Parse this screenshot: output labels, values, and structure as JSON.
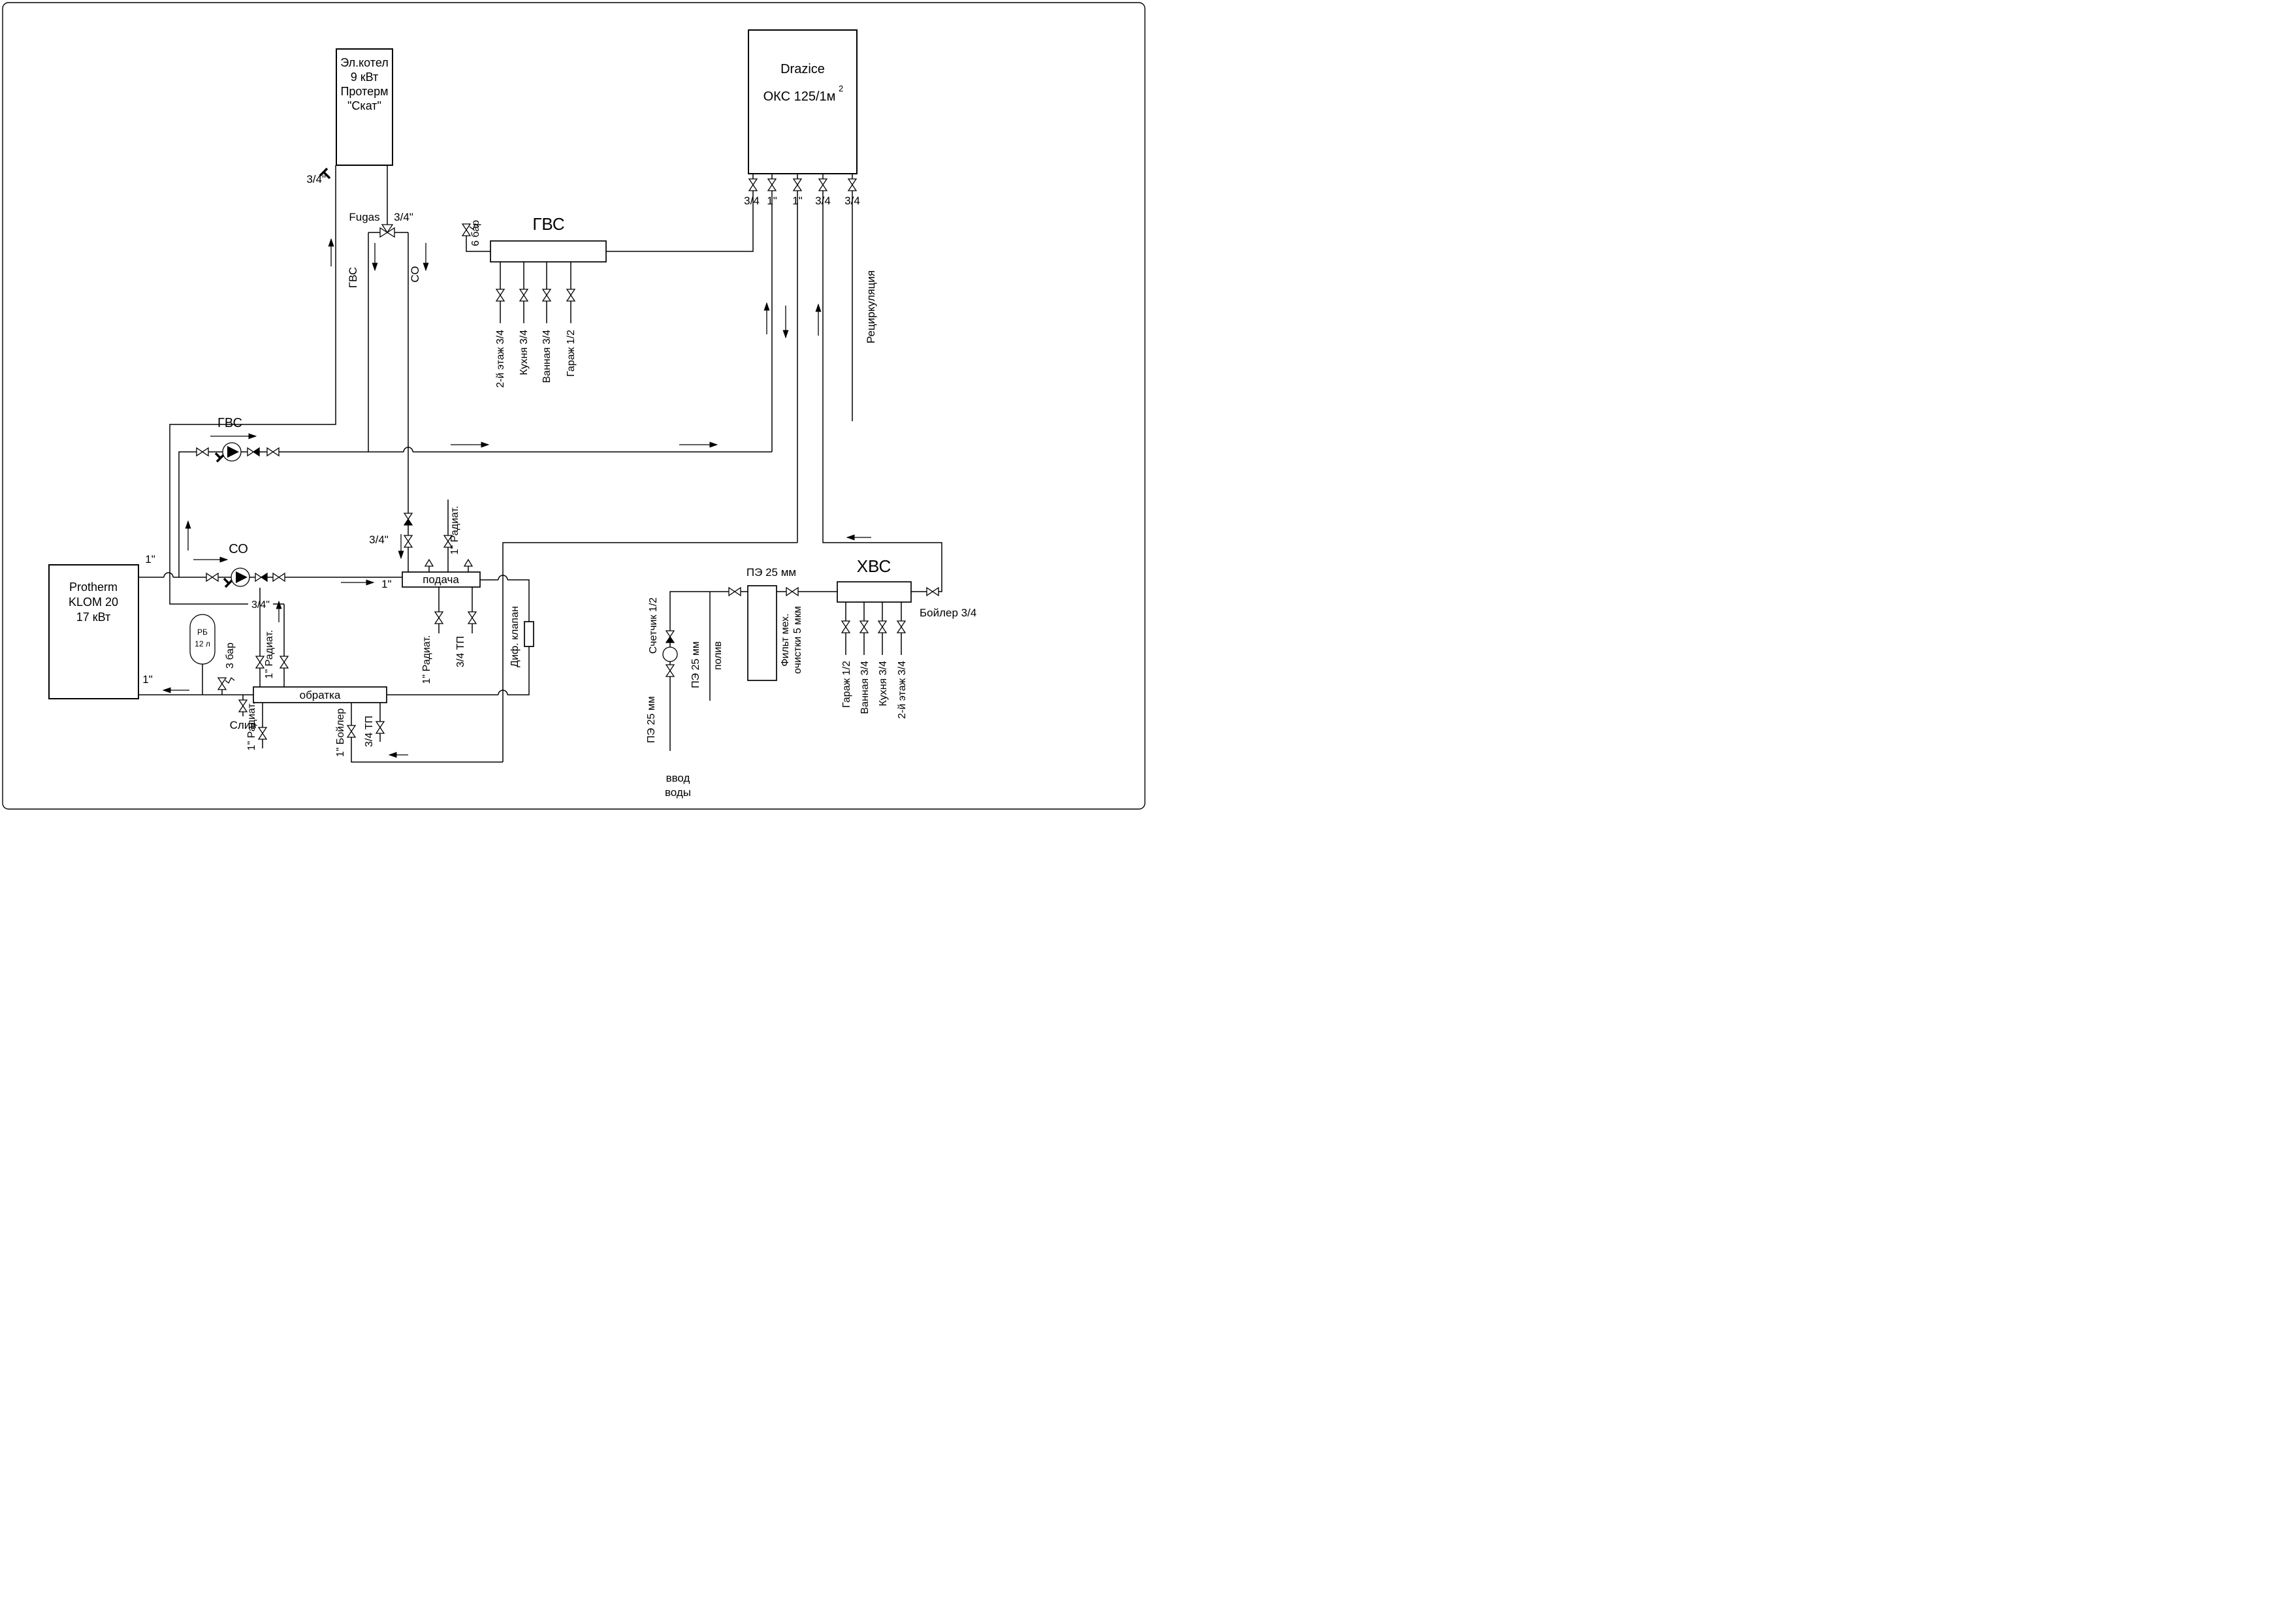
{
  "electric_boiler": {
    "lines": [
      "Эл.котел",
      "9 кВт",
      "Протерм",
      "\"Скат\""
    ]
  },
  "klom_boiler": {
    "lines": [
      "Protherm",
      "KLOM 20",
      "17 кВт"
    ]
  },
  "drazice": {
    "name": "Drazice",
    "model": "ОКС 125/1м",
    "model_sup": "2",
    "port_sizes": [
      "3/4",
      "1\"",
      "1\"",
      "3/4",
      "3/4"
    ]
  },
  "expansion_tank": {
    "line1": "РБ",
    "line2": "12 л"
  },
  "manifolds": {
    "gvs": {
      "title": "ГВС",
      "outlets": [
        "2-й этаж 3/4",
        "Кухня 3/4",
        "Ванная 3/4",
        "Гараж 1/2"
      ]
    },
    "hvs": {
      "title": "ХВС",
      "outlets": [
        "Гараж 1/2",
        "Ванная 3/4",
        "Кухня 3/4",
        "2-й этаж 3/4"
      ]
    },
    "supply": {
      "label": "подача"
    },
    "return": {
      "label": "обратка"
    }
  },
  "labels": {
    "elbow_size": "3/4\"",
    "fugas": "Fugas",
    "fugas_size": "3/4\"",
    "gvs_branch": "ГВС",
    "co_branch": "СО",
    "gvs_pump": "ГВС",
    "co_pump": "СО",
    "supply_size": "1\"",
    "supply_size_right": "1\"",
    "return_size": "1\"",
    "bar6": "6 бар",
    "bar3": "3 бар",
    "drain": "Слив",
    "co_riser_size": "3/4\"",
    "elec_return_size": "3/4\"",
    "recirculation": "Рециркуляция",
    "boiler34": "Бойлер 3/4",
    "rad_supply": "1\" Радиат.",
    "dif_valve": "Диф. клапан",
    "podacha_out1": "1\" Радиат.",
    "podacha_out2": "3/4 ТП",
    "obratka_top": "1\" Радиат.",
    "obratka_out1": "1\" Радиат.",
    "obratka_out2": "1\" Бойлер",
    "obratka_out3": "3/4 ТП",
    "meter": "Счетчик 1/2",
    "pe25_inlet": "ПЭ 25 мм",
    "pe25_poliv": "ПЭ 25 мм",
    "pe25_filter": "ПЭ 25 мм",
    "poliv": "полив",
    "filter_l1": "Фильт мех.",
    "filter_l2": "очистки 5 мкм",
    "inlet_l1": "ввод",
    "inlet_l2": "воды"
  }
}
